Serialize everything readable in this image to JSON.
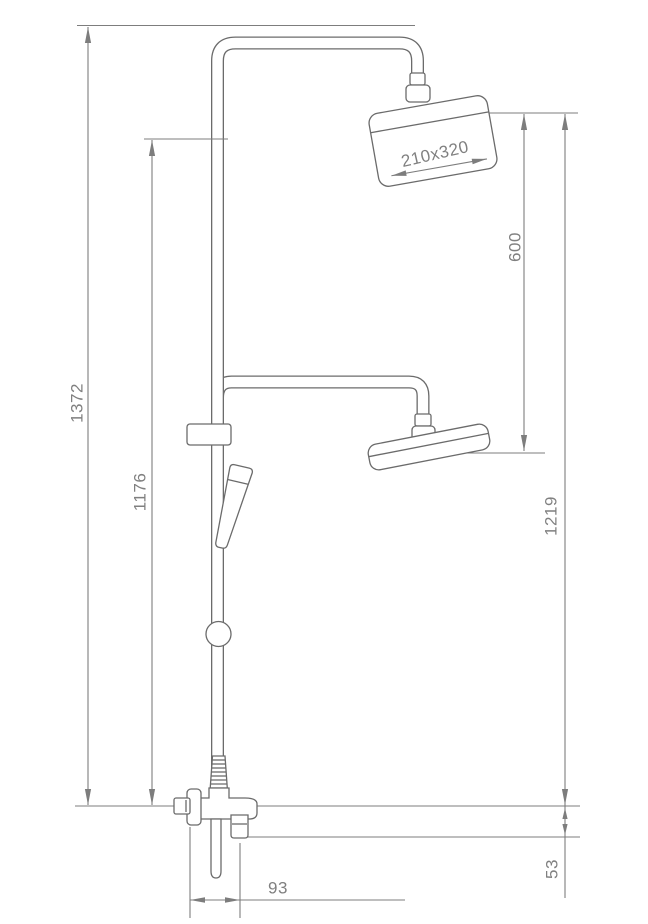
{
  "drawing": {
    "colors": {
      "background": "#ffffff",
      "fixture_line": "#6b6b6b",
      "dimension_line": "#7d7d7d",
      "label_text": "#808080"
    },
    "labels": {
      "overall_height": "1372",
      "riser_height": "1176",
      "head_to_head": "600",
      "lower_head_height": "1219",
      "spout_drop": "53",
      "spout_reach": "93",
      "head_size": "210x320"
    }
  }
}
